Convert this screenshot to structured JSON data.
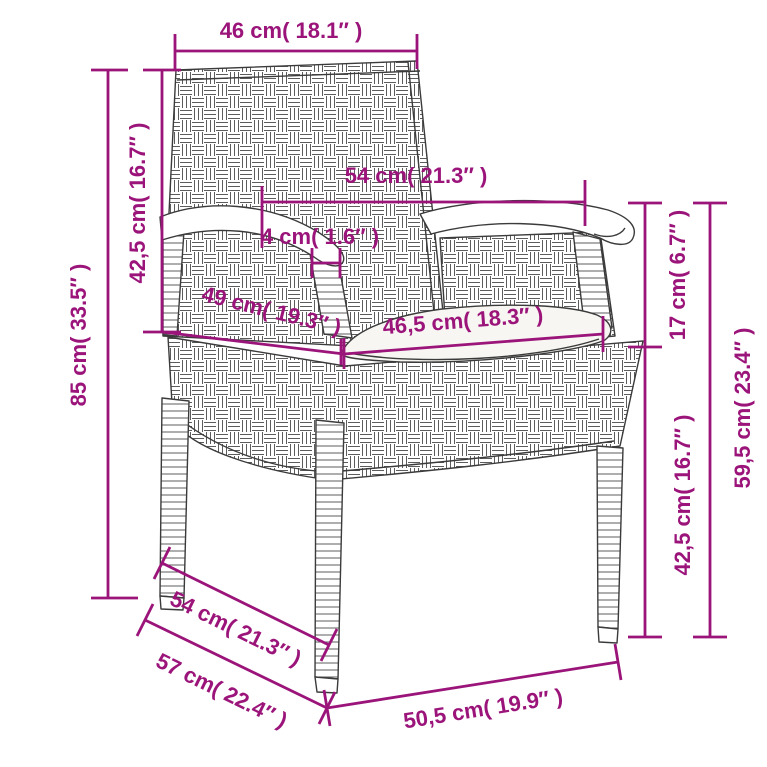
{
  "diagram": {
    "type": "product-dimension-diagram",
    "subject": "poly rattan garden chair with seat cushion",
    "colors": {
      "dimension_accent": "#9b147a",
      "line_art": "#3b3b3b",
      "background": "#ffffff",
      "cushion_fill": "#f7f6f2"
    },
    "units": [
      "cm",
      "inch"
    ]
  },
  "dimensions": {
    "back_width": {
      "cm": "46",
      "inch": "18.1",
      "label": "46 cm( 18.1″ )"
    },
    "total_height": {
      "cm": "85",
      "inch": "33.5",
      "label": "85 cm( 33.5″ )"
    },
    "backrest_height": {
      "cm": "42,5",
      "inch": "16.7",
      "label": "42,5 cm( 16.7″ )"
    },
    "armrest_span": {
      "cm": "54",
      "inch": "21.3",
      "label": "54 cm( 21.3″ )"
    },
    "armrest_width": {
      "cm": "4",
      "inch": "1.6",
      "label": "4 cm( 1.6″ )"
    },
    "seat_depth": {
      "cm": "49",
      "inch": "19.3",
      "label": "49 cm( 19.3″ )"
    },
    "seat_width": {
      "cm": "46,5",
      "inch": "18.3",
      "label": "46,5 cm( 18.3″ )"
    },
    "arm_to_seat": {
      "cm": "17",
      "inch": "6.7",
      "label": "17 cm( 6.7″ )"
    },
    "seat_height": {
      "cm": "42,5",
      "inch": "16.7",
      "label": "42,5 cm( 16.7″ )"
    },
    "armrest_height": {
      "cm": "59,5",
      "inch": "23.4",
      "label": "59,5 cm( 23.4″ )"
    },
    "base_depth": {
      "cm": "54",
      "inch": "21.3",
      "label": "54 cm( 21.3″ )"
    },
    "base_depth_outer": {
      "cm": "57",
      "inch": "22.4",
      "label": "57 cm( 22.4″ )"
    },
    "base_width": {
      "cm": "50,5",
      "inch": "19.9",
      "label": "50,5 cm( 19.9″ )"
    }
  }
}
